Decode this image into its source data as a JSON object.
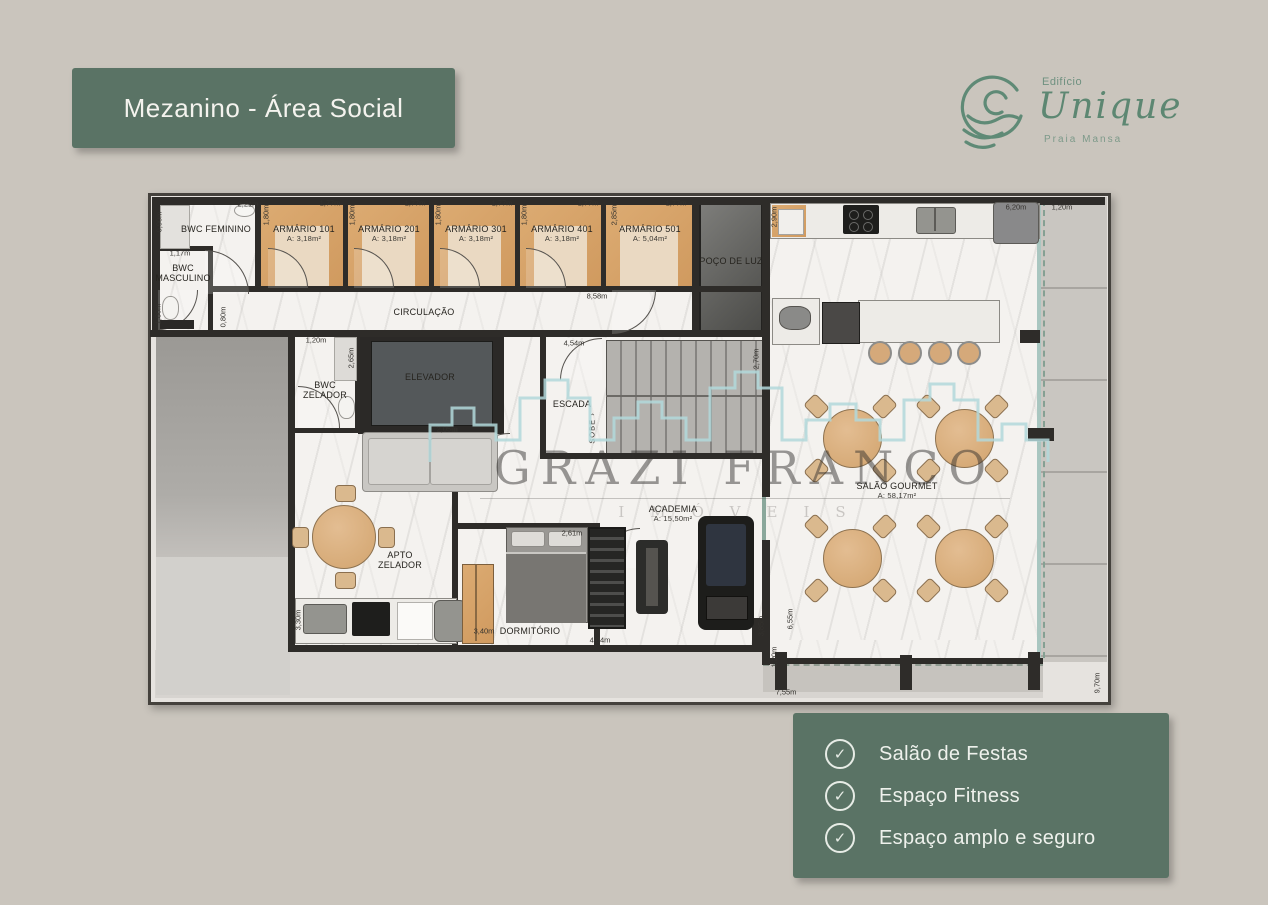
{
  "page": {
    "background": "#cac5bd",
    "accent_green": "#5a7365",
    "logo_green": "#5d8772"
  },
  "title_box": {
    "label": "Mezanino - Área Social"
  },
  "logo": {
    "icon": "wave-circle-icon",
    "prefix": "Edifício",
    "name": "Unique",
    "subtitle": "Praia Mansa"
  },
  "features_box": {
    "items": [
      {
        "icon": "check-circle-icon",
        "label": "Salão de Festas"
      },
      {
        "icon": "check-circle-icon",
        "label": "Espaço Fitness"
      },
      {
        "icon": "check-circle-icon",
        "label": "Espaço amplo e  seguro"
      }
    ]
  },
  "watermark": {
    "line1": "GRAZI FRANCO",
    "line2": "IMÓVEIS",
    "icon": "city-skyline-icon"
  },
  "plan": {
    "stair_direction_label": "SOBE",
    "rooms": [
      {
        "name": "BWC FEMININO",
        "x": 216,
        "y": 229
      },
      {
        "name": "BWC MASCULINO",
        "x": 183,
        "y": 273,
        "w": 58
      },
      {
        "name": "ARMÁRIO 101",
        "area": "A: 3,18m²",
        "x": 304,
        "y": 234
      },
      {
        "name": "ARMÁRIO 201",
        "area": "A: 3,18m²",
        "x": 389,
        "y": 234
      },
      {
        "name": "ARMÁRIO 301",
        "area": "A: 3,18m²",
        "x": 476,
        "y": 234
      },
      {
        "name": "ARMÁRIO 401",
        "area": "A: 3,18m²",
        "x": 562,
        "y": 234
      },
      {
        "name": "ARMÁRIO 501",
        "area": "A: 5,04m²",
        "x": 650,
        "y": 234
      },
      {
        "name": "POÇO DE LUZ",
        "x": 731,
        "y": 261
      },
      {
        "name": "CIRCULAÇÃO",
        "x": 424,
        "y": 312
      },
      {
        "name": "ELEVADOR",
        "x": 430,
        "y": 377
      },
      {
        "name": "BWC ZELADOR",
        "x": 325,
        "y": 390,
        "w": 56
      },
      {
        "name": "ESCADA",
        "x": 572,
        "y": 404
      },
      {
        "name": "APTO ZELADOR",
        "x": 400,
        "y": 560,
        "w": 66
      },
      {
        "name": "DORMITÓRIO",
        "x": 530,
        "y": 631
      },
      {
        "name": "ACADEMIA",
        "area": "A: 15,50m²",
        "x": 673,
        "y": 514
      },
      {
        "name": "SALÃO GOURMET",
        "area": "A: 58,17m²",
        "x": 897,
        "y": 491
      }
    ],
    "dims": [
      {
        "v": "2,21m",
        "x": 248,
        "y": 204
      },
      {
        "v": "0,90m",
        "x": 159,
        "y": 222,
        "r": 1
      },
      {
        "v": "1,17m",
        "x": 180,
        "y": 253
      },
      {
        "v": "1,77m",
        "x": 330,
        "y": 203
      },
      {
        "v": "1,77m",
        "x": 415,
        "y": 203
      },
      {
        "v": "1,77m",
        "x": 502,
        "y": 203
      },
      {
        "v": "1,77m",
        "x": 588,
        "y": 203
      },
      {
        "v": "1,77m",
        "x": 676,
        "y": 203
      },
      {
        "v": "1,80m",
        "x": 266,
        "y": 215,
        "r": 1
      },
      {
        "v": "1,80m",
        "x": 352,
        "y": 215,
        "r": 1
      },
      {
        "v": "1,80m",
        "x": 438,
        "y": 215,
        "r": 1
      },
      {
        "v": "1,80m",
        "x": 524,
        "y": 215,
        "r": 1
      },
      {
        "v": "2,85m",
        "x": 614,
        "y": 215,
        "r": 1
      },
      {
        "v": "1,80m",
        "x": 158,
        "y": 314,
        "r": 1
      },
      {
        "v": "0,80m",
        "x": 223,
        "y": 317,
        "r": 1
      },
      {
        "v": "8,58m",
        "x": 597,
        "y": 296
      },
      {
        "v": "1,20m",
        "x": 316,
        "y": 340
      },
      {
        "v": "2,65m",
        "x": 351,
        "y": 358,
        "r": 1
      },
      {
        "v": "2,05m",
        "x": 447,
        "y": 429
      },
      {
        "v": "4,54m",
        "x": 574,
        "y": 343
      },
      {
        "v": "2,70m",
        "x": 756,
        "y": 359,
        "r": 1
      },
      {
        "v": "2,90m",
        "x": 774,
        "y": 217,
        "r": 1
      },
      {
        "v": "6,20m",
        "x": 1016,
        "y": 207
      },
      {
        "v": "1,20m",
        "x": 1062,
        "y": 207
      },
      {
        "v": "2,61m",
        "x": 572,
        "y": 533
      },
      {
        "v": "3,40m",
        "x": 484,
        "y": 631
      },
      {
        "v": "3,30m",
        "x": 298,
        "y": 620,
        "r": 1
      },
      {
        "v": "4,04m",
        "x": 600,
        "y": 640
      },
      {
        "v": "3,85m",
        "x": 761,
        "y": 626,
        "r": 1
      },
      {
        "v": "6,55m",
        "x": 790,
        "y": 619,
        "r": 1
      },
      {
        "v": "1,20m",
        "x": 774,
        "y": 657,
        "r": 1
      },
      {
        "v": "7,55m",
        "x": 786,
        "y": 692
      },
      {
        "v": "9,70m",
        "x": 1097,
        "y": 683,
        "r": 1
      }
    ]
  }
}
